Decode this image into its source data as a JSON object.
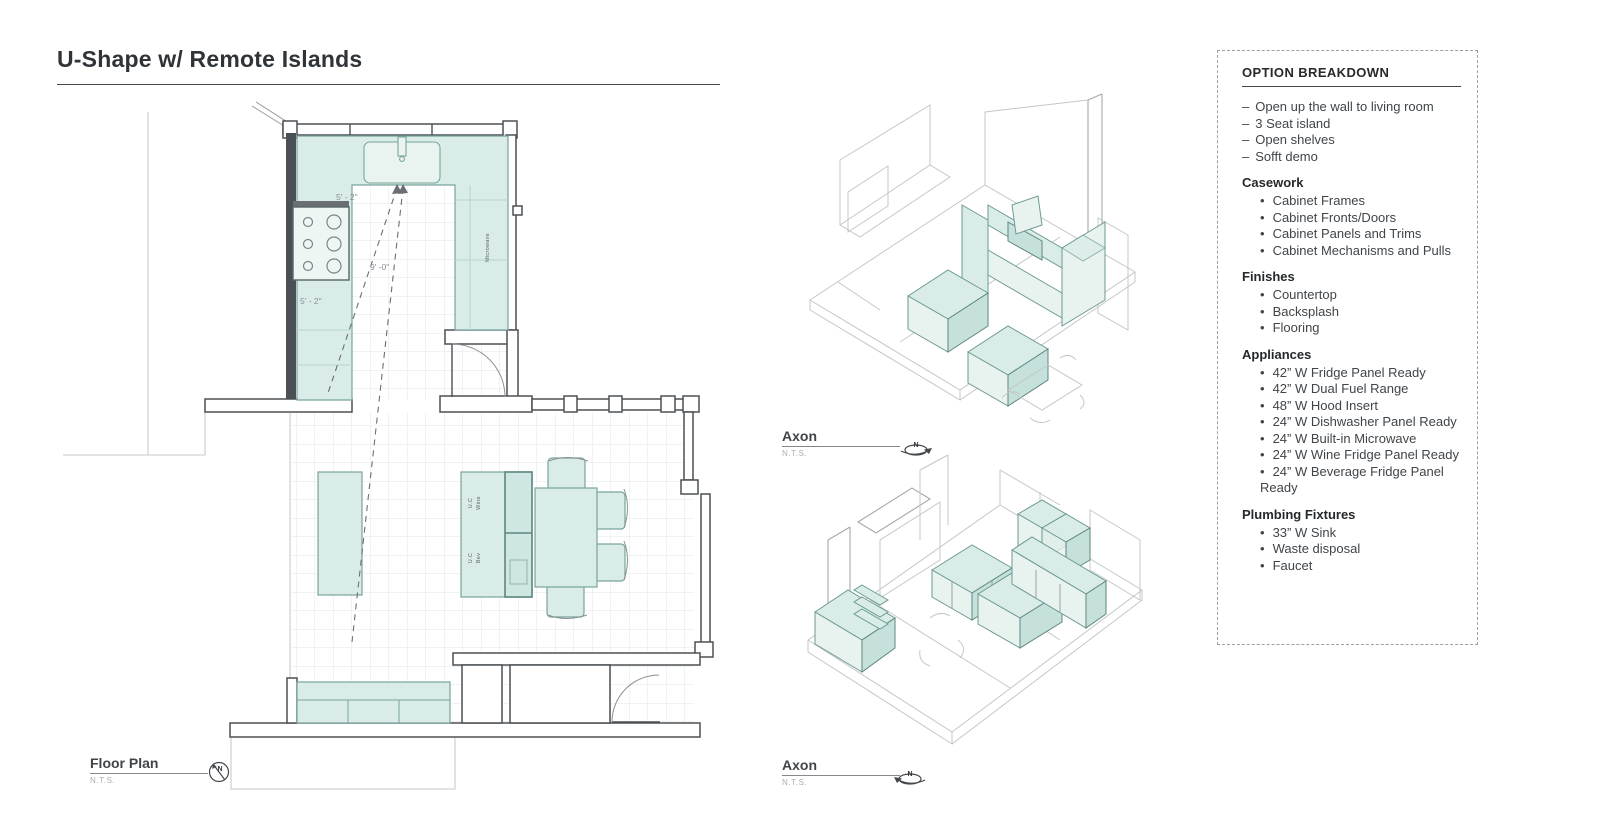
{
  "title": "U-Shape w/ Remote Islands",
  "glyphs": {
    "bullet": "•",
    "dash": "–"
  },
  "floor_plan": {
    "label": "Floor Plan",
    "scale": "N.T.S.",
    "compass": "N",
    "dim_top": "5' - 2\"",
    "dim_diag": "9' -0\"",
    "dim_left": "5' - 2\"",
    "microwave": "Microwave",
    "uc_wine_line1": "U.C",
    "uc_wine_line2": "Wine",
    "uc_bev_line1": "U.C",
    "uc_bev_line2": "Bev"
  },
  "axons": {
    "top": {
      "label": "Axon",
      "scale": "N.T.S.",
      "compass": "N"
    },
    "bottom": {
      "label": "Axon",
      "scale": "N.T.S.",
      "compass": "N"
    }
  },
  "option_breakdown": {
    "title": "OPTION BREAKDOWN",
    "notes": [
      "Open up the wall to living room",
      "3 Seat island",
      "Open shelves",
      "Sofft demo"
    ],
    "sections": [
      {
        "heading": "Casework",
        "items": [
          "Cabinet Frames",
          "Cabinet Fronts/Doors",
          "Cabinet Panels and Trims",
          "Cabinet Mechanisms and Pulls"
        ]
      },
      {
        "heading": "Finishes",
        "items": [
          "Countertop",
          "Backsplash",
          "Flooring"
        ]
      },
      {
        "heading": "Appliances",
        "items": [
          "42” W Fridge Panel Ready",
          "42” W  Dual Fuel Range",
          "48” W Hood Insert",
          "24” W Dishwasher Panel Ready",
          "24” W Built-in Microwave",
          "24” W Wine Fridge Panel Ready",
          "24” W Beverage Fridge Panel Ready"
        ]
      },
      {
        "heading": "Plumbing Fixtures",
        "items": [
          "33” W Sink",
          "Waste disposal",
          "Faucet"
        ]
      }
    ]
  },
  "colors": {
    "accent_fill": "#d9ece8",
    "accent_stroke": "#79a49d",
    "wall": "#4b5054",
    "text_dark": "#2f3438",
    "text_muted": "#a8adb1",
    "grid": "#e2e6e8"
  }
}
